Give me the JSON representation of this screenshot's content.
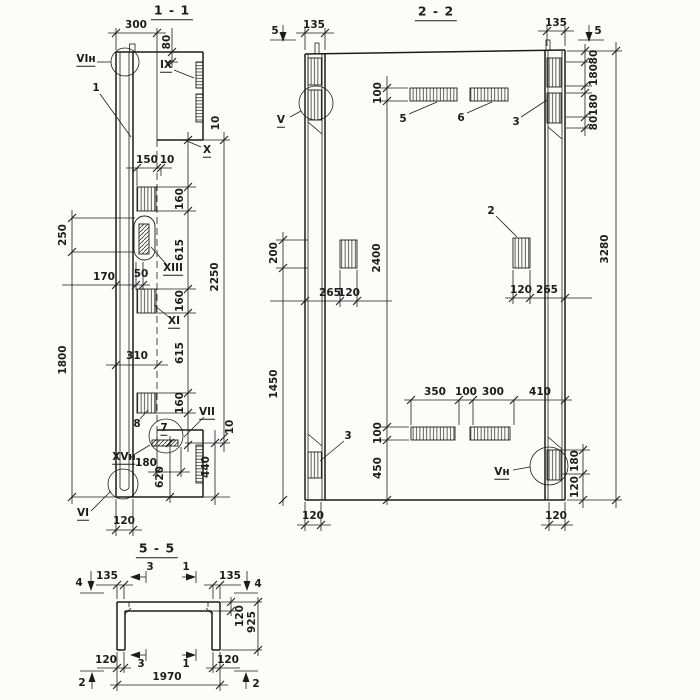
{
  "colors": {
    "ink": "#1c1c1c",
    "paper": "#fcfcfb"
  },
  "s11": {
    "title": "1 - 1",
    "callout_vin": "VIн",
    "callout_ix": "IX",
    "callout_x": "X",
    "callout_xiii": "XIII",
    "callout_xi": "XI",
    "callout_vii": "VII",
    "callout_xvn": "XVн",
    "callout_vi": "VI",
    "part_1": "1",
    "part_7": "7",
    "part_8": "8",
    "dim_300": "300",
    "dim_80": "80",
    "dim_10a": "10",
    "dim_150": "150",
    "dim_10b": "10",
    "dim_250": "250",
    "dim_1800": "1800",
    "dim_170": "170",
    "dim_50": "50",
    "dim_160a": "160",
    "dim_615a": "615",
    "dim_160b": "160",
    "dim_615b": "615",
    "dim_160c": "160",
    "dim_2250": "2250",
    "dim_310": "310",
    "dim_10c": "10",
    "dim_180": "180",
    "dim_620": "620",
    "dim_440": "440",
    "dim_120": "120"
  },
  "s22": {
    "title": "2 - 2",
    "marker_5l": "5",
    "marker_5r": "5",
    "callout_v": "V",
    "callout_vn": "Vн",
    "part_5": "5",
    "part_6": "6",
    "part_3top": "3",
    "part_2": "2",
    "part_3bot": "3",
    "dim_135l": "135",
    "dim_135r": "135",
    "dim_80a": "80",
    "dim_180a": "180",
    "dim_180b": "180",
    "dim_80b": "80",
    "dim_3280": "3280",
    "dim_100top": "100",
    "dim_2400": "2400",
    "dim_100bot": "100",
    "dim_450": "450",
    "dim_200": "200",
    "dim_1450": "1450",
    "dim_265l": "265",
    "dim_120l": "120",
    "dim_120r": "120",
    "dim_265r": "265",
    "dim_350": "350",
    "dim_100c": "100",
    "dim_300": "300",
    "dim_410": "410",
    "dim_180c": "180",
    "dim_120c": "120",
    "dim_120bl": "120",
    "dim_120br": "120"
  },
  "s55": {
    "title": "5 - 5",
    "marker_4l": "4",
    "marker_4r": "4",
    "marker_2l": "2",
    "marker_2r": "2",
    "cut_3top": "3",
    "cut_1top": "1",
    "cut_3bot": "3",
    "cut_1bot": "1",
    "dim_135l": "135",
    "dim_135r": "135",
    "dim_120slab": "120",
    "dim_925": "925",
    "dim_120bl": "120",
    "dim_120br": "120",
    "dim_1970": "1970"
  }
}
